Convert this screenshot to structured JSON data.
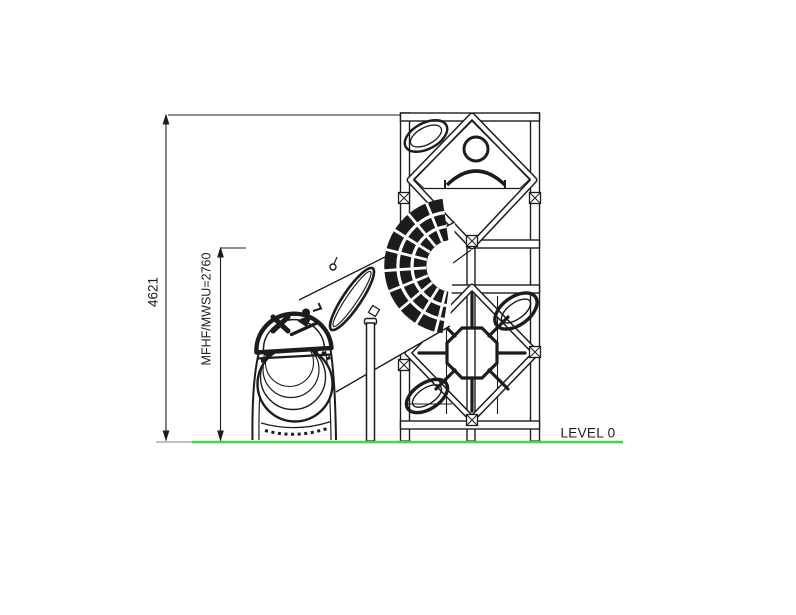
{
  "colors": {
    "ink": "#1c1c1c",
    "ground_line": "#42da42",
    "background": "#ffffff",
    "extension_gray": "#9a9a9a"
  },
  "labels": {
    "total_height": "4621",
    "fall_height": "MFHF/MWSU=2760",
    "ground_level": "LEVEL 0"
  },
  "icons": {
    "slide_sign": "no-climbing-person-on-slide-icon",
    "perforated_panel": "checker-hatch-panel",
    "climbing_web": "octagon-spider-web-net",
    "portholes": "oval-window"
  },
  "drawing": {
    "type": "elevation",
    "subject": "playground tower with tube slide"
  }
}
